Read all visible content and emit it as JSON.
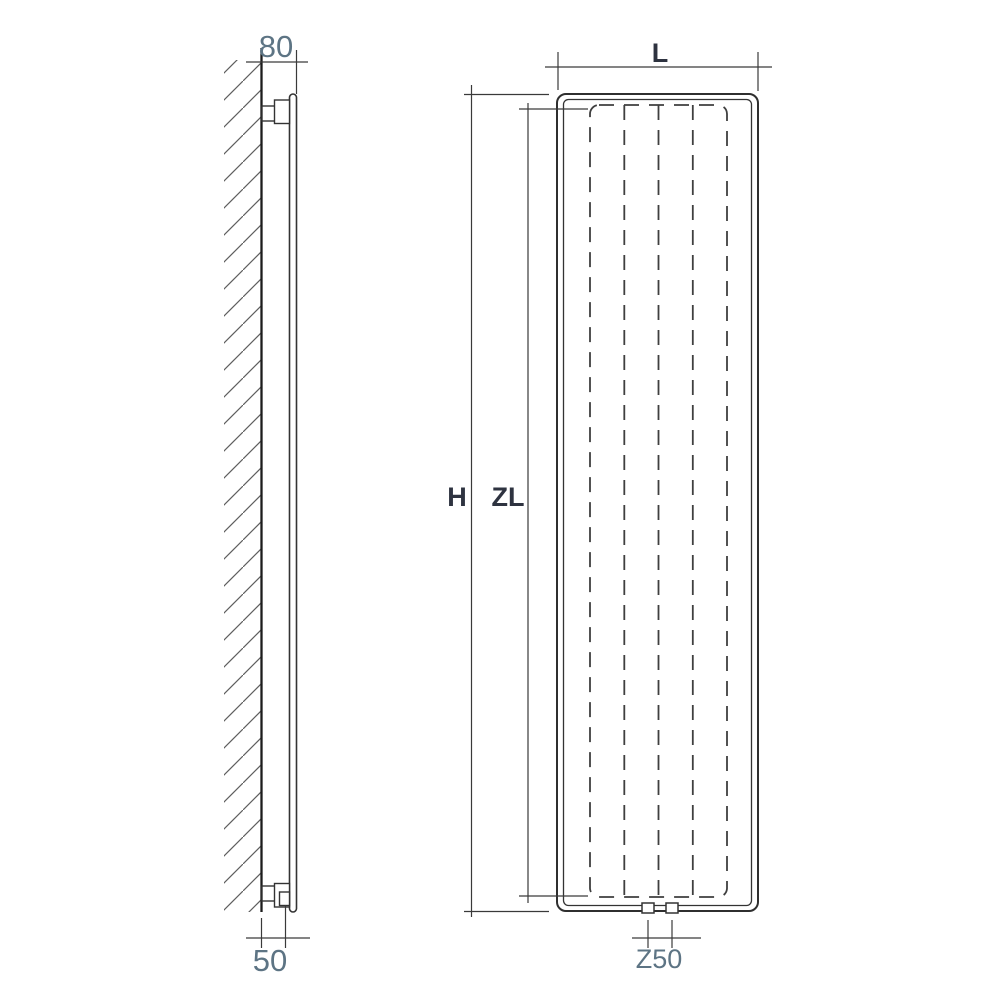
{
  "diagram": {
    "subject": "Vertical panel radiator technical drawing - wall-mounted side view and front elevation",
    "views": {
      "side": "side-view-wall-mounted",
      "front": "front-elevation"
    },
    "dimensions": {
      "wall_to_front_face": "80",
      "wall_to_pipe_center": "50",
      "width": "L",
      "height": "H",
      "heated_length": "ZL",
      "connection_spacing": "Z50"
    },
    "front_view": {
      "channel_count": 5
    },
    "colors": {
      "line": "#3a3a3a",
      "wall_line": "#1c1c1c",
      "numeric_label": "#5d7484",
      "letter_label": "#2e3340",
      "background": "#ffffff"
    }
  }
}
